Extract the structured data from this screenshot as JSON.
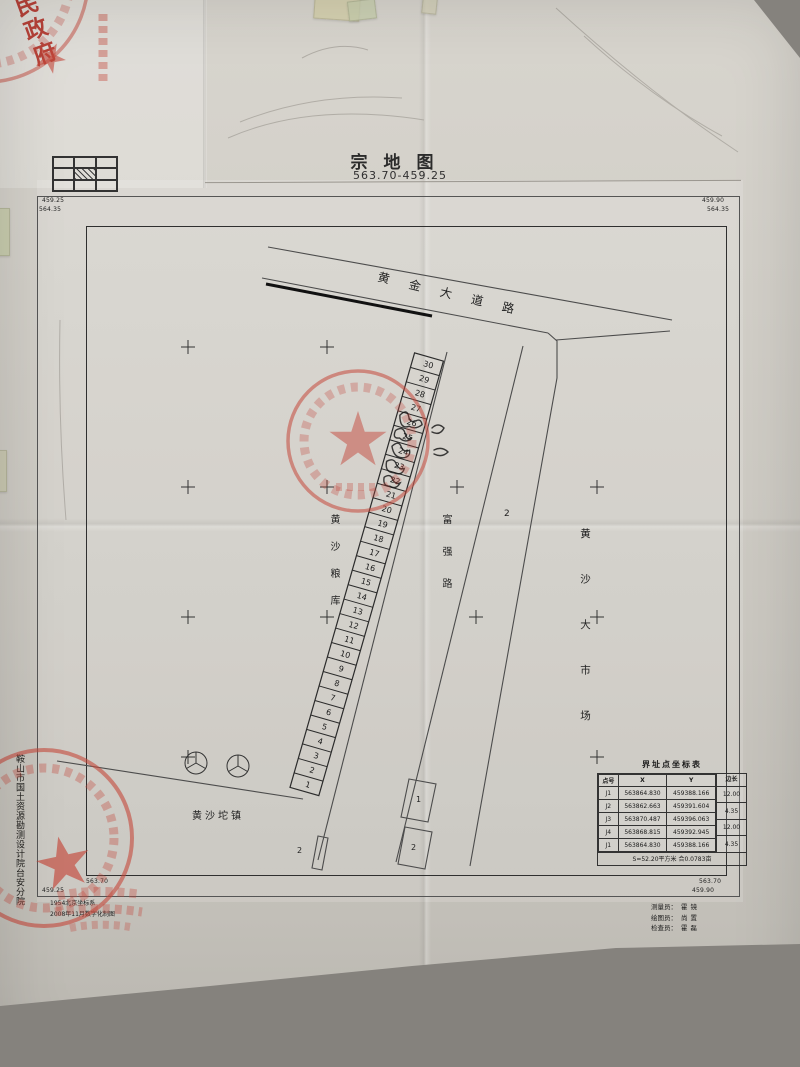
{
  "title": {
    "main": "宗地图",
    "number": "563.70-459.25"
  },
  "frame_labels": {
    "top_left_y": "459.25",
    "top_left_x": "564.35",
    "top_right_y": "459.90",
    "top_right_x": "564.35",
    "bottom_left_x": "563.70",
    "bottom_left_y": "459.25",
    "bottom_right_x": "563.70",
    "bottom_right_y": "459.90"
  },
  "map": {
    "road_top": "黄金大道路",
    "road_middle": "富强路",
    "label_granary": "黄沙粮库",
    "label_market": "黄沙大市场",
    "label_town": "黄沙坨镇",
    "plot_numbers": [
      30,
      29,
      28,
      27,
      26,
      25,
      24,
      23,
      22,
      21,
      20,
      19,
      18,
      17,
      16,
      15,
      14,
      13,
      12,
      11,
      10,
      9,
      8,
      7,
      6,
      5,
      4,
      3,
      2,
      1
    ],
    "parcel_labels": {
      "market_region": "2",
      "small_parcel_top": "1",
      "small_parcel_bottom": "2",
      "left_parcel": "2"
    }
  },
  "coordinate_table": {
    "title": "界址点坐标表",
    "headers": [
      "点号",
      "X",
      "Y",
      "边长"
    ],
    "points": [
      {
        "id": "J1",
        "x": "563864.830",
        "y": "459388.166"
      },
      {
        "id": "J2",
        "x": "563862.663",
        "y": "459391.604"
      },
      {
        "id": "J3",
        "x": "563870.487",
        "y": "459396.063"
      },
      {
        "id": "J4",
        "x": "563868.815",
        "y": "459392.945"
      },
      {
        "id": "J1",
        "x": "563864.830",
        "y": "459388.166"
      }
    ],
    "side_lengths": [
      "12.00",
      "4.35",
      "12.00",
      "4.35"
    ],
    "footer": "S=52.20平方米 合0.0783亩"
  },
  "credits": {
    "surveyor_label": "测量员：",
    "surveyor": "霍镜",
    "drafter_label": "绘图员：",
    "drafter": "尚置",
    "checker_label": "检查员：",
    "checker": "霍磊"
  },
  "notes": {
    "datum": "1954北京坐标系",
    "production": "2008年11月数字化制图"
  },
  "institution": "鞍山市国土资源勘测设计院台安分院",
  "stamps": {
    "top_left_fragment": "民政府"
  }
}
